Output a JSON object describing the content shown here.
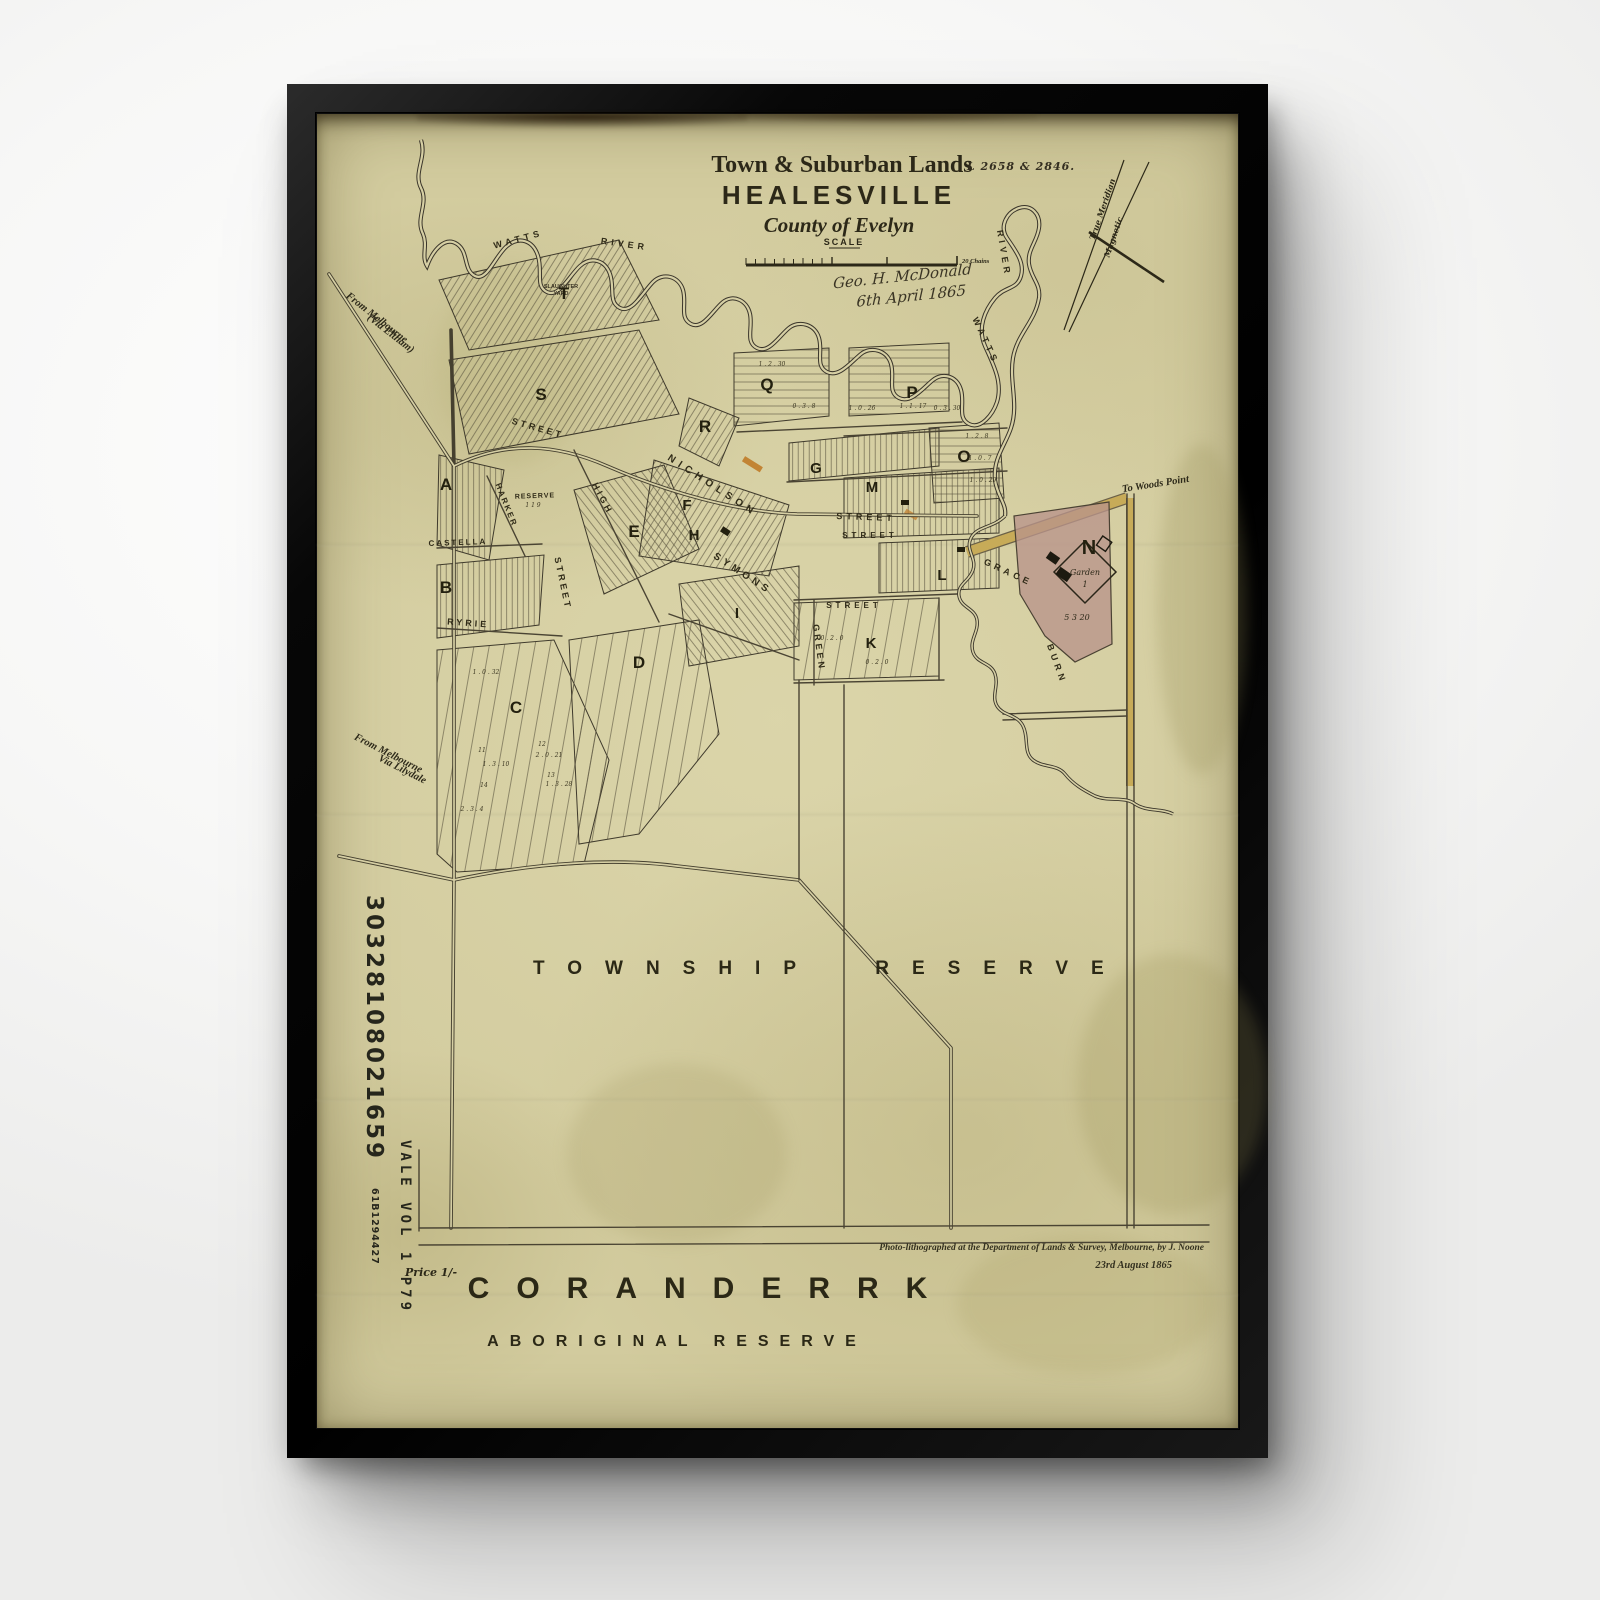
{
  "frame": {
    "color": "#0b0b0b",
    "wall": "#f5f5f4"
  },
  "paper": {
    "color": "#d3cc9f",
    "ink": "#2c2818",
    "road_wash": "#c7ab58",
    "reserve_wash": "#b8948a",
    "lot_highlight": "#c07b28"
  },
  "map": {
    "title_block": {
      "kicker": "Town & Suburban Lands",
      "title": "HEALESVILLE",
      "subtitle": "County of Evelyn"
    },
    "plan_ref": "L 2658 & 2846.",
    "scale": {
      "label": "SCALE",
      "unit": "20 Chains"
    },
    "signature": {
      "line1": "Geo. H. McDonald",
      "line2": "6th April 1865"
    },
    "meridian": {
      "true_label": "True Meridian",
      "magnetic_label": "Magnetic"
    },
    "routes": {
      "eltham_1": "From Melbourne",
      "eltham_2": "(Via Eltham)",
      "lilydale_1": "From Melbourne",
      "lilydale_2": "Via Lilydale",
      "woods_point": "To Woods Point"
    },
    "township": {
      "word1": "TOWNSHIP",
      "word2": "RESERVE"
    },
    "coranderrk": {
      "title": "CORANDERRK",
      "subtitle": "ABORIGINAL RESERVE"
    },
    "price": "Price 1/-",
    "credits": {
      "line1": "Photo-lithographed at the Department of Lands & Survey, Melbourne, by J. Noone",
      "line2": "23rd August 1865"
    },
    "margin_notes": {
      "note1": "30328108021659",
      "note2": "61B1294427",
      "note3": "VALE VOL 1 P79"
    },
    "garden": {
      "label": "Garden",
      "number": "1",
      "area": "5 3 20"
    },
    "slaughter_yard": {
      "line1": "SLAUGHTER",
      "line2": "YARD"
    },
    "block_letters": [
      {
        "t": "T",
        "x": 247,
        "y": 185,
        "s": 17
      },
      {
        "t": "S",
        "x": 224,
        "y": 286,
        "s": 17
      },
      {
        "t": "A",
        "x": 129,
        "y": 376,
        "s": 17
      },
      {
        "t": "B",
        "x": 129,
        "y": 479,
        "s": 17
      },
      {
        "t": "C",
        "x": 199,
        "y": 599,
        "s": 17
      },
      {
        "t": "D",
        "x": 322,
        "y": 554,
        "s": 17
      },
      {
        "t": "E",
        "x": 317,
        "y": 423,
        "s": 17
      },
      {
        "t": "F",
        "x": 370,
        "y": 396,
        "s": 15
      },
      {
        "t": "H",
        "x": 377,
        "y": 426,
        "s": 15
      },
      {
        "t": "I",
        "x": 420,
        "y": 504,
        "s": 15
      },
      {
        "t": "K",
        "x": 554,
        "y": 534,
        "s": 15
      },
      {
        "t": "L",
        "x": 625,
        "y": 466,
        "s": 15
      },
      {
        "t": "M",
        "x": 555,
        "y": 378,
        "s": 15
      },
      {
        "t": "G",
        "x": 499,
        "y": 359,
        "s": 15
      },
      {
        "t": "Q",
        "x": 450,
        "y": 276,
        "s": 17
      },
      {
        "t": "P",
        "x": 595,
        "y": 284,
        "s": 17
      },
      {
        "t": "O",
        "x": 647,
        "y": 348,
        "s": 17
      },
      {
        "t": "R",
        "x": 388,
        "y": 318,
        "s": 17
      },
      {
        "t": "N",
        "x": 772,
        "y": 440,
        "s": 20
      }
    ],
    "street_labels": [
      {
        "t": "NICHOLSON",
        "x": 394,
        "y": 374,
        "r": 33,
        "s": 10,
        "ls": 5
      },
      {
        "t": "STREET",
        "x": 549,
        "y": 406,
        "r": 2,
        "s": 9,
        "ls": 4
      },
      {
        "t": "HIGH",
        "x": 283,
        "y": 386,
        "r": 62,
        "s": 9,
        "ls": 3
      },
      {
        "t": "STREET",
        "x": 243,
        "y": 470,
        "r": 78,
        "s": 9,
        "ls": 3
      },
      {
        "t": "SYMONS",
        "x": 424,
        "y": 462,
        "r": 33,
        "s": 10,
        "ls": 4
      },
      {
        "t": "STREET",
        "x": 553,
        "y": 424,
        "s": 8,
        "ls": 4
      },
      {
        "t": "STREET",
        "x": 537,
        "y": 494,
        "s": 8,
        "ls": 4
      },
      {
        "t": "GREEN",
        "x": 499,
        "y": 534,
        "r": 82,
        "s": 9,
        "ls": 3
      },
      {
        "t": "CASTELLA",
        "x": 141,
        "y": 431,
        "r": -2,
        "s": 8,
        "ls": 2
      },
      {
        "t": "RYRIE",
        "x": 151,
        "y": 512,
        "r": 4,
        "s": 9,
        "ls": 3
      },
      {
        "t": "HARKER",
        "x": 187,
        "y": 392,
        "r": 68,
        "s": 8,
        "ls": 2
      },
      {
        "t": "RESERVE",
        "x": 218,
        "y": 384,
        "r": -2,
        "s": 7,
        "ls": 1
      },
      {
        "t": "STREET",
        "x": 220,
        "y": 317,
        "r": 16,
        "s": 9,
        "ls": 3
      }
    ],
    "water_labels": [
      {
        "t": "WATTS",
        "x": 202,
        "y": 128,
        "r": -15,
        "s": 9,
        "ls": 4
      },
      {
        "t": "RIVER",
        "x": 307,
        "y": 133,
        "r": 8,
        "s": 9,
        "ls": 4
      },
      {
        "t": "RIVER",
        "x": 684,
        "y": 140,
        "r": 80,
        "s": 9,
        "ls": 4
      },
      {
        "t": "WATTS",
        "x": 666,
        "y": 228,
        "r": 65,
        "s": 9,
        "ls": 4
      },
      {
        "t": "GRACE",
        "x": 690,
        "y": 461,
        "r": 25,
        "s": 9,
        "ls": 4
      },
      {
        "t": "BURN",
        "x": 737,
        "y": 551,
        "r": 70,
        "s": 9,
        "ls": 4
      }
    ],
    "lot_numbers": [
      {
        "t": "1 . 2 . 30",
        "x": 455,
        "y": 252,
        "s": 6
      },
      {
        "t": "0 . 3 . 8",
        "x": 487,
        "y": 294,
        "s": 6
      },
      {
        "t": "1 . 0 . 26",
        "x": 545,
        "y": 296,
        "s": 6
      },
      {
        "t": "1 . 1 . 17",
        "x": 596,
        "y": 294,
        "s": 6
      },
      {
        "t": "0 . 3 . 30",
        "x": 630,
        "y": 296,
        "s": 6
      },
      {
        "t": "1 . 2 . 8",
        "x": 660,
        "y": 324,
        "s": 6
      },
      {
        "t": "1 . 0 . 7",
        "x": 663,
        "y": 346,
        "s": 6
      },
      {
        "t": "1 . 0 . 29",
        "x": 666,
        "y": 368,
        "s": 6
      },
      {
        "t": "0 . 2 . 0",
        "x": 515,
        "y": 526,
        "s": 6
      },
      {
        "t": "0 . 2 . 0",
        "x": 560,
        "y": 550,
        "s": 6
      },
      {
        "t": "1 . 0 . 32",
        "x": 169,
        "y": 560,
        "s": 6
      },
      {
        "t": "11",
        "x": 165,
        "y": 638,
        "s": 6
      },
      {
        "t": "12",
        "x": 225,
        "y": 632,
        "s": 6
      },
      {
        "t": "2 . 0 . 21",
        "x": 232,
        "y": 643,
        "s": 6
      },
      {
        "t": "1 . 3 . 10",
        "x": 179,
        "y": 652,
        "s": 6
      },
      {
        "t": "13",
        "x": 234,
        "y": 663,
        "s": 6
      },
      {
        "t": "14",
        "x": 167,
        "y": 673,
        "s": 6
      },
      {
        "t": "1 . 3 . 28",
        "x": 242,
        "y": 672,
        "s": 6
      },
      {
        "t": "2 . 3 . 4",
        "x": 155,
        "y": 697,
        "s": 6
      },
      {
        "t": "1 1 9",
        "x": 216,
        "y": 393,
        "s": 6
      }
    ]
  }
}
